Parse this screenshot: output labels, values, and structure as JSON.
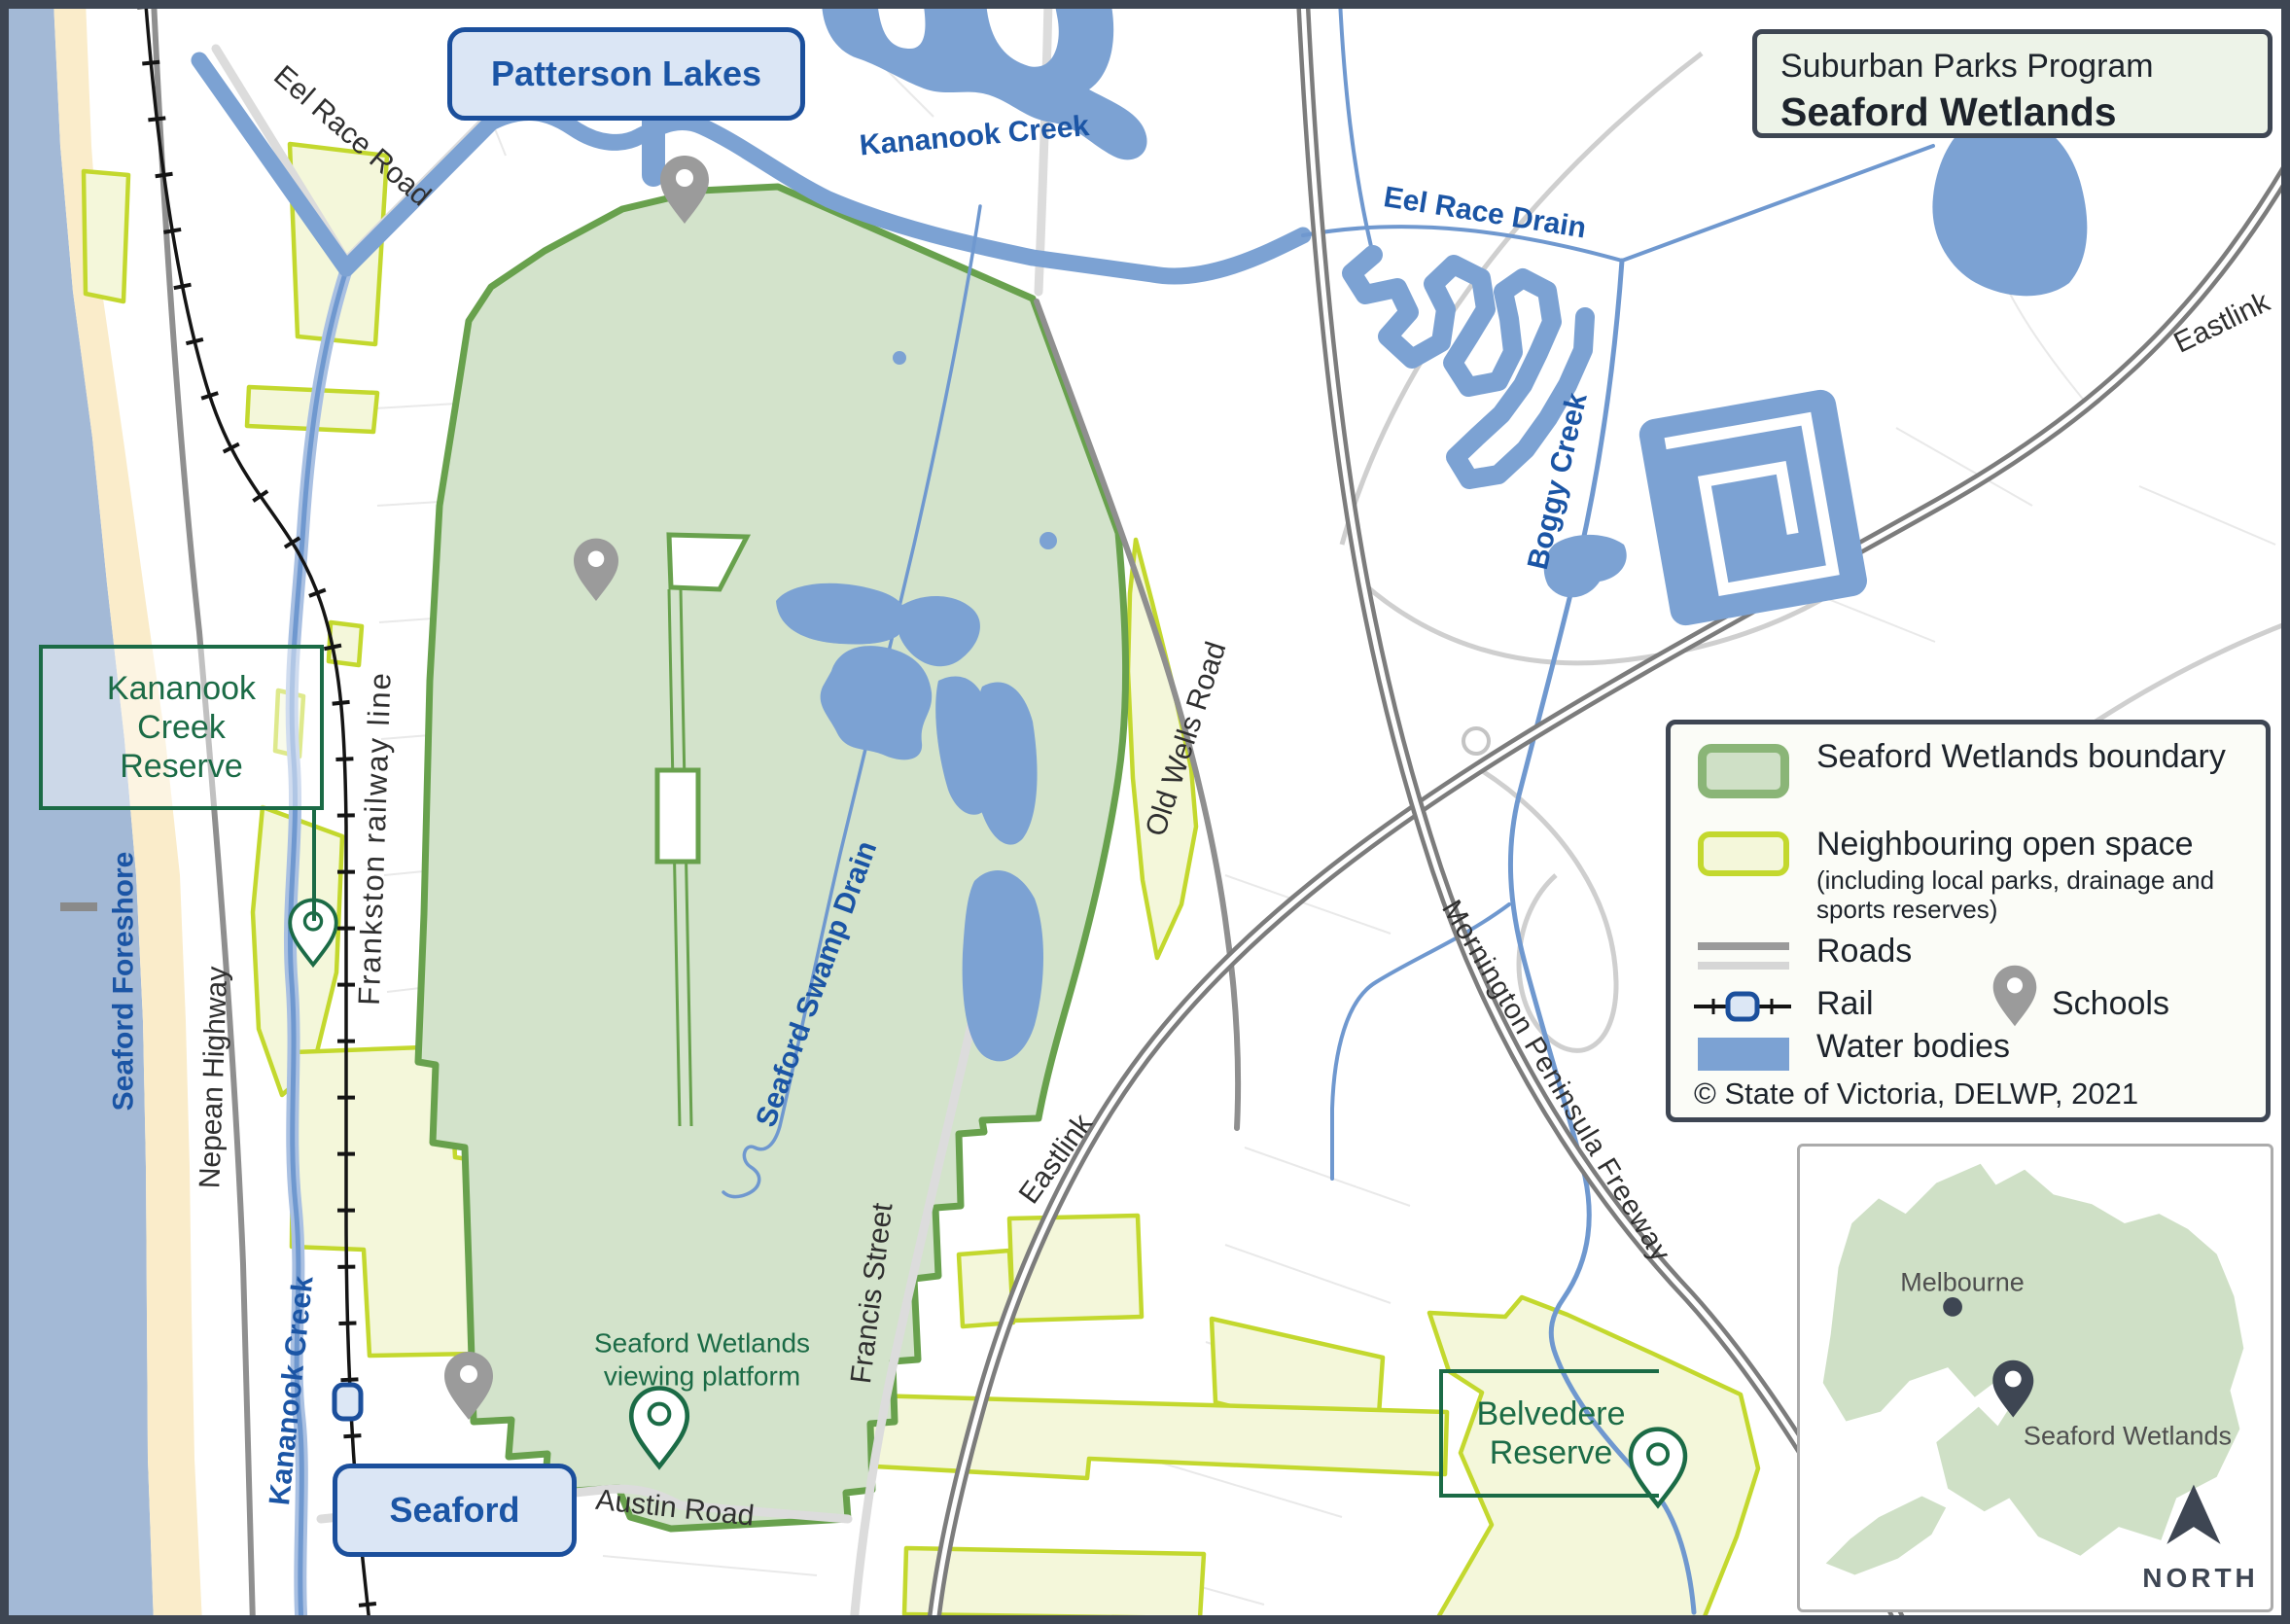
{
  "title_box": {
    "program": "Suburban Parks Program",
    "name": "Seaford Wetlands"
  },
  "legend": {
    "items": [
      {
        "label": "Seaford Wetlands boundary"
      },
      {
        "label": "Neighbouring open space",
        "note": "(including local parks, drainage and sports reserves)"
      },
      {
        "label": "Roads"
      },
      {
        "label": "Rail"
      },
      {
        "label": "Schools"
      },
      {
        "label": "Water bodies"
      }
    ],
    "copyright": "© State of Victoria, DELWP, 2021"
  },
  "town_boxes": {
    "patterson_lakes": "Patterson Lakes",
    "seaford": "Seaford"
  },
  "map_labels": {
    "kananook_creek_reserve": "Kananook Creek Reserve",
    "seaford_foreshore": "Seaford Foreshore",
    "nepean_highway": "Nepean Highway",
    "frankston_railway_line": "Frankston railway line",
    "kananook_creek_west": "Kananook Creek",
    "kananook_creek_top": "Kananook Creek",
    "eel_race_road": "Eel Race Road",
    "eel_race_drain": "Eel Race Drain",
    "boggy_creek": "Boggy Creek",
    "eastlink_top": "Eastlink",
    "eastlink_bottom": "Eastlink",
    "old_wells_road": "Old Wells Road",
    "seaford_swamp_drain": "Seaford Swamp Drain",
    "mornington_peninsula_freeway": "Mornington Peninsula Freeway",
    "francis_street": "Francis Street",
    "austin_road": "Austin Road",
    "viewing_platform": "Seaford Wetlands viewing platform",
    "belvedere_reserve": "Belvedere Reserve"
  },
  "inset": {
    "city": "Melbourne",
    "site": "Seaford Wetlands",
    "north": "NORTH"
  },
  "colors": {
    "frame": "#3e4653",
    "wetland_fill": "#d3e3cb",
    "wetland_border": "#68a14d",
    "open_space_fill": "#f4f7da",
    "open_space_border": "#c3d82e",
    "water": "#7ca2d3",
    "creek_line": "#6f98cf",
    "sea": "#a3b9d6",
    "sand": "#faecca",
    "road_major": "#8f8f8f",
    "road_minor": "#d8d8d8",
    "freeway": "#7c7c7c",
    "rail": "#141414",
    "label_blue": "#1b55a5",
    "label_green": "#1b6b46",
    "town_box_fill": "#dbe6f5",
    "town_box_border": "#1b4f9c",
    "school_pin": "#9b9b9b"
  }
}
